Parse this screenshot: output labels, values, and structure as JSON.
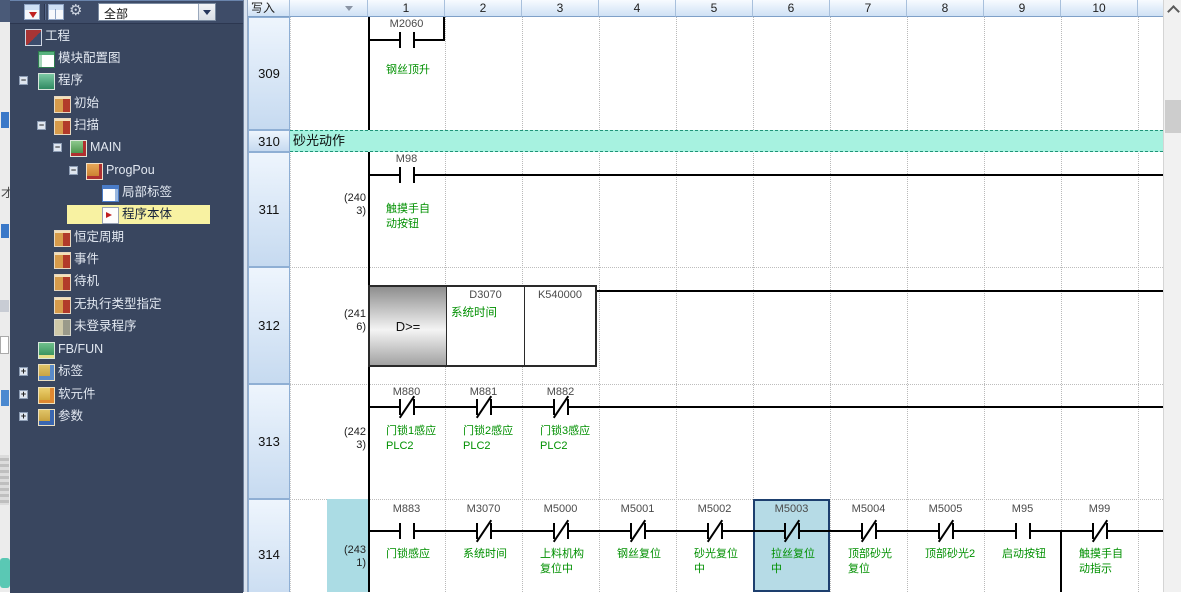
{
  "sidebar": {
    "toolbar": {
      "filter_value": "全部",
      "icons": [
        "sort-window-icon",
        "layout-window-icon",
        "gear-icon"
      ]
    },
    "tree": [
      {
        "label": "工程",
        "level": 0,
        "icon": "project-icon"
      },
      {
        "label": "模块配置图",
        "level": 1,
        "icon": "module-config-icon"
      },
      {
        "label": "程序",
        "level": 1,
        "icon": "program-folder-icon",
        "expander": "minus"
      },
      {
        "label": "初始",
        "level": 2,
        "icon": "program-item-icon"
      },
      {
        "label": "扫描",
        "level": 2,
        "icon": "program-item-icon",
        "expander": "minus"
      },
      {
        "label": "MAIN",
        "level": 3,
        "icon": "main-program-icon",
        "expander": "minus"
      },
      {
        "label": "ProgPou",
        "level": 4,
        "icon": "pou-icon",
        "expander": "minus"
      },
      {
        "label": "局部标签",
        "level": 5,
        "icon": "local-label-icon"
      },
      {
        "label": "程序本体",
        "level": 5,
        "icon": "program-body-icon",
        "selected": true
      },
      {
        "label": "恒定周期",
        "level": 2,
        "icon": "program-item-icon"
      },
      {
        "label": "事件",
        "level": 2,
        "icon": "program-item-icon"
      },
      {
        "label": "待机",
        "level": 2,
        "icon": "program-item-icon"
      },
      {
        "label": "无执行类型指定",
        "level": 2,
        "icon": "program-item-icon"
      },
      {
        "label": "未登录程序",
        "level": 2,
        "icon": "unregistered-program-icon"
      },
      {
        "label": "FB/FUN",
        "level": 1,
        "icon": "fb-fun-icon"
      },
      {
        "label": "标签",
        "level": 1,
        "icon": "label-folder-icon",
        "expander": "plus"
      },
      {
        "label": "软元件",
        "level": 1,
        "icon": "device-folder-icon",
        "expander": "plus"
      },
      {
        "label": "参数",
        "level": 1,
        "icon": "parameter-folder-icon",
        "expander": "plus"
      }
    ]
  },
  "ladder": {
    "mode_label": "写入",
    "columns": [
      "1",
      "2",
      "3",
      "4",
      "5",
      "6",
      "7",
      "8",
      "9",
      "10"
    ],
    "colors": {
      "comment_green": "#009000",
      "rung_comment_bg": "#a7f2e0",
      "selection_fill": "#b6dbe6",
      "selection_border": "#1d3f6e",
      "tree_selection": "#f8f2a2"
    },
    "rows": [
      {
        "num": "309",
        "type": "rung",
        "cells": [
          {
            "device": "M2060",
            "type": "NO",
            "comment": "钢丝顶升"
          }
        ]
      },
      {
        "num": "310",
        "type": "comment",
        "comment": "砂光动作"
      },
      {
        "num": "311",
        "type": "rung",
        "step1": "(240",
        "step2": "3)",
        "cells": [
          {
            "device": "M98",
            "type": "NO",
            "comment": "触摸手自\n动按钮"
          }
        ]
      },
      {
        "num": "312",
        "type": "rung",
        "step1": "(241",
        "step2": "6)",
        "block": {
          "op": "D>=",
          "operand1": "D3070",
          "operand1_comment": "系统时间",
          "operand2": "K540000"
        }
      },
      {
        "num": "313",
        "type": "rung",
        "step1": "(242",
        "step2": "3)",
        "cells": [
          {
            "device": "M880",
            "type": "NC",
            "comment": "门锁1感应\nPLC2"
          },
          {
            "device": "M881",
            "type": "NC",
            "comment": "门锁2感应\nPLC2"
          },
          {
            "device": "M882",
            "type": "NC",
            "comment": "门锁3感应\nPLC2"
          }
        ]
      },
      {
        "num": "314",
        "type": "rung",
        "step1": "(243",
        "step2": "1)",
        "cells": [
          {
            "device": "M883",
            "type": "NO",
            "comment": "门锁感应"
          },
          {
            "device": "M3070",
            "type": "NC",
            "comment": "系统时间"
          },
          {
            "device": "M5000",
            "type": "NC",
            "comment": "上料机构\n复位中"
          },
          {
            "device": "M5001",
            "type": "NC",
            "comment": "钢丝复位"
          },
          {
            "device": "M5002",
            "type": "NC",
            "comment": "砂光复位\n中"
          },
          {
            "device": "M5003",
            "type": "NC",
            "comment": "拉丝复位\n中",
            "selected": true
          },
          {
            "device": "M5004",
            "type": "NC",
            "comment": "顶部砂光\n复位"
          },
          {
            "device": "M5005",
            "type": "NC",
            "comment": "顶部砂光2"
          },
          {
            "device": "M95",
            "type": "NO",
            "comment": "启动按钮"
          },
          {
            "device": "M99",
            "type": "NC",
            "comment": "触摸手自\n动指示"
          }
        ]
      }
    ]
  }
}
